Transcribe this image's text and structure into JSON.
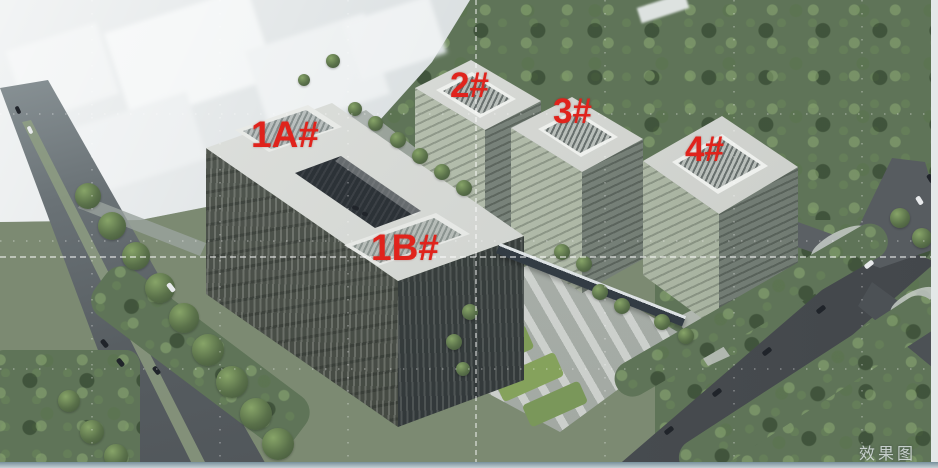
{
  "annotations": {
    "buildings": [
      {
        "id": "1A",
        "label": "1A#"
      },
      {
        "id": "1B",
        "label": "1B#"
      },
      {
        "id": "2",
        "label": "2#"
      },
      {
        "id": "3",
        "label": "3#"
      },
      {
        "id": "4",
        "label": "4#"
      }
    ],
    "watermark": "效果图"
  },
  "colors": {
    "label_red": "#e0231c",
    "watermark_gray": "rgba(218,226,226,0.85)",
    "roof_gray": "#d6d8d4",
    "glass_facade_dark": "#4b514c",
    "forest_green": "#5f7458",
    "road_gray": "#53585c",
    "plaza_gray": "#b6bcb6",
    "haze_white": "#dfe5e6"
  }
}
